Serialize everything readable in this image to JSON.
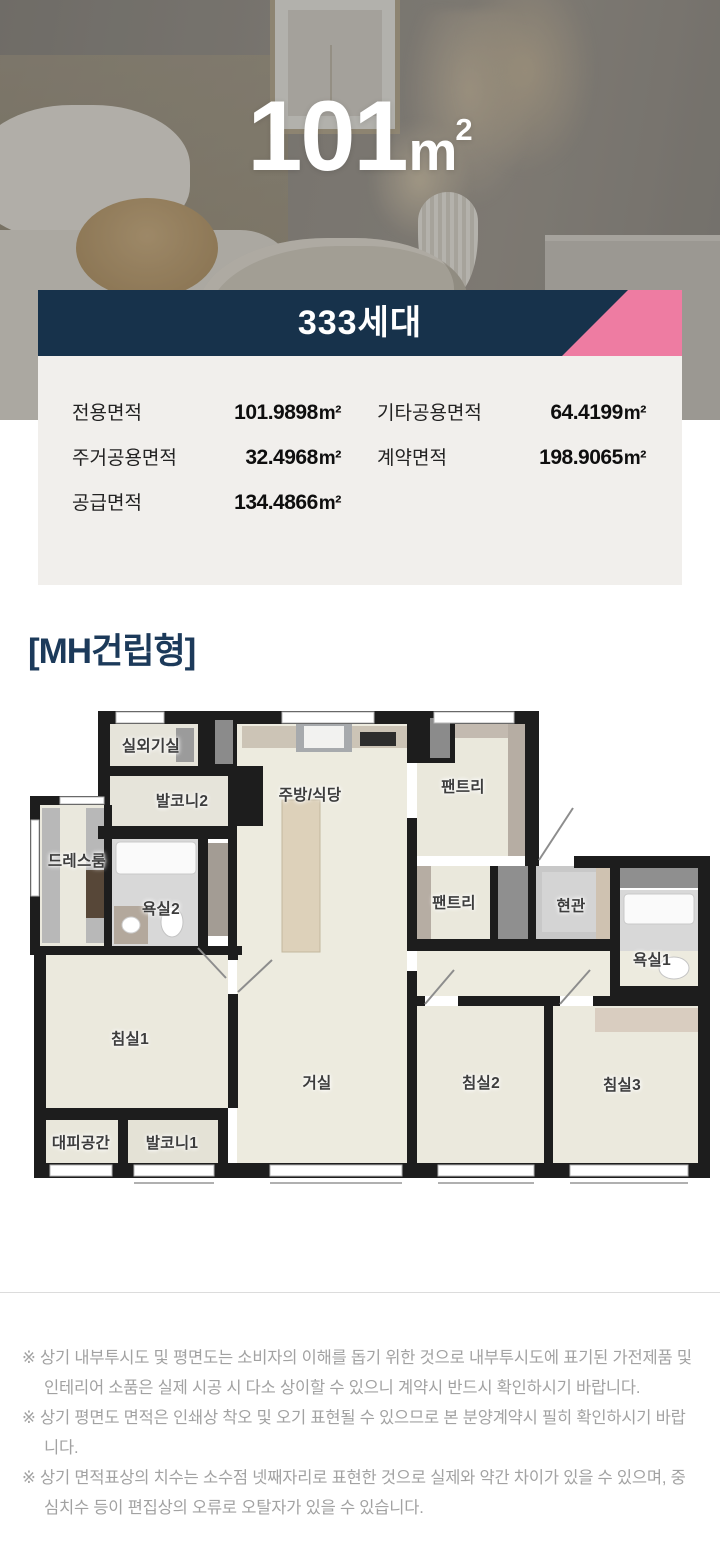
{
  "hero": {
    "size_number": "101",
    "size_unit": "m",
    "size_unit_sup": "2"
  },
  "banner": {
    "households": "333세대",
    "navy_color": "#17324b",
    "accent_color": "#ee7ca2"
  },
  "area_table": {
    "rows_left": [
      {
        "label": "전용면적",
        "value": "101.9898",
        "unit": "m²"
      },
      {
        "label": "주거공용면적",
        "value": "32.4968",
        "unit": "m²"
      },
      {
        "label": "공급면적",
        "value": "134.4866",
        "unit": "m²"
      }
    ],
    "rows_right": [
      {
        "label": "기타공용면적",
        "value": "64.4199",
        "unit": "m²"
      },
      {
        "label": "계약면적",
        "value": "198.9065",
        "unit": "m²"
      }
    ]
  },
  "plan": {
    "type_label": "[MH건립형]",
    "rooms": [
      {
        "name": "실외기실",
        "x": 121,
        "y": 37
      },
      {
        "name": "발코니2",
        "x": 152,
        "y": 92
      },
      {
        "name": "주방/식당",
        "x": 280,
        "y": 86
      },
      {
        "name": "팬트리",
        "x": 433,
        "y": 78
      },
      {
        "name": "드레스룸",
        "x": 47,
        "y": 152
      },
      {
        "name": "욕실2",
        "x": 131,
        "y": 200
      },
      {
        "name": "팬트리",
        "x": 424,
        "y": 194
      },
      {
        "name": "현관",
        "x": 541,
        "y": 197
      },
      {
        "name": "욕실1",
        "x": 622,
        "y": 251
      },
      {
        "name": "침실1",
        "x": 100,
        "y": 330
      },
      {
        "name": "거실",
        "x": 287,
        "y": 374
      },
      {
        "name": "침실2",
        "x": 451,
        "y": 374
      },
      {
        "name": "침실3",
        "x": 592,
        "y": 376
      },
      {
        "name": "대피공간",
        "x": 51,
        "y": 434
      },
      {
        "name": "발코니1",
        "x": 142,
        "y": 434
      }
    ]
  },
  "disclaimers": [
    "※ 상기 내부투시도 및 평면도는 소비자의 이해를 돕기 위한 것으로 내부투시도에 표기된 가전제품 및 인테리어 소품은 실제 시공 시 다소 상이할 수 있으니 계약시 반드시 확인하시기 바랍니다.",
    "※ 상기 평면도 면적은 인쇄상 착오 및 오기 표현될 수 있으므로 본 분양계약시 필히 확인하시기 바랍니다.",
    "※ 상기 면적표상의 치수는 소수점 넷째자리로 표현한 것으로 실제와 약간 차이가 있을 수 있으며, 중심치수 등이 편집상의 오류로 오탈자가 있을 수 있습니다."
  ]
}
